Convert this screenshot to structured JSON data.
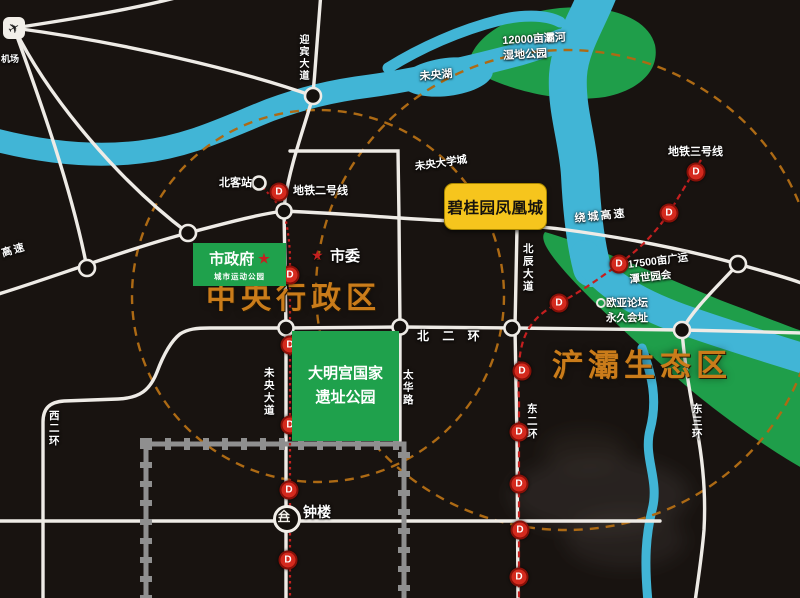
{
  "colors": {
    "background": "#181310",
    "river": "#41b5d6",
    "park_green": "#1f9e4a",
    "road": "#eeebe6",
    "metro_red": "#c51f1f",
    "radius_dash_orange": "#ad6a14",
    "zone_text_orange": "#ca7c1a",
    "project_highlight_yellow": "#f6c51d",
    "city_wall_gray": "#8f8f8f",
    "gov_box_green": "#1fa14c",
    "star_red": "#c42020"
  },
  "project": {
    "name": "碧桂园凤凰城"
  },
  "boxes": {
    "government": {
      "title": "市政府",
      "subtitle": "城市运动公园"
    },
    "daminggong": {
      "text": "大明宫国家\n遗址公园"
    }
  },
  "metro": {
    "marker_letter": "D",
    "line2_label": "地铁二号线",
    "line3_label": "地铁三号线",
    "line2_markers": [
      [
        279,
        192
      ],
      [
        290,
        275
      ],
      [
        290,
        345
      ],
      [
        290,
        425
      ],
      [
        289,
        490
      ],
      [
        288,
        560
      ]
    ],
    "line3_markers": [
      [
        696,
        172
      ],
      [
        669,
        213
      ],
      [
        619,
        264
      ],
      [
        559,
        303
      ],
      [
        522,
        371
      ],
      [
        519,
        432
      ],
      [
        519,
        484
      ],
      [
        520,
        530
      ],
      [
        519,
        577
      ]
    ]
  },
  "labels": [
    {
      "id": "airport-label",
      "t": "机场",
      "x": 1,
      "y": 53,
      "s": 9
    },
    {
      "id": "yingbin-avenue-label",
      "t": "迎宾大道",
      "x": 295,
      "y": 34,
      "s": 10,
      "v": 1
    },
    {
      "id": "weiyang-lake-label",
      "t": "未央湖",
      "x": 419,
      "y": 70,
      "s": 11,
      "r": -5
    },
    {
      "id": "wetland-park-label",
      "t": "12000亩灞河\n湿地公园",
      "x": 502,
      "y": 34,
      "s": 11,
      "r": -3
    },
    {
      "id": "north-station-label",
      "t": "北客站",
      "x": 219,
      "y": 176,
      "s": 11
    },
    {
      "id": "metro-line2-label",
      "t": "地铁二号线",
      "x": 293,
      "y": 184,
      "s": 11
    },
    {
      "id": "weiyang-university-label",
      "t": "未央大学城",
      "x": 414,
      "y": 160,
      "s": 10.5,
      "r": -8
    },
    {
      "id": "metro-line3-label",
      "t": "地铁三号线",
      "x": 668,
      "y": 145,
      "s": 11
    },
    {
      "id": "ring-expressway-label",
      "t": "绕城高速",
      "x": 574,
      "y": 212,
      "s": 11,
      "r": -6,
      "ls": 2
    },
    {
      "id": "expressway-label",
      "t": "高速",
      "x": 0,
      "y": 247,
      "s": 10.5,
      "r": -16,
      "ls": 2
    },
    {
      "id": "beichen-avenue-label",
      "t": "北辰大道",
      "x": 520,
      "y": 243,
      "s": 10.5,
      "v": 1
    },
    {
      "id": "municipal-committee-label",
      "t": "市委",
      "x": 330,
      "y": 246,
      "s": 15
    },
    {
      "id": "north-2nd-ring-label",
      "t": "北 二 环",
      "x": 417,
      "y": 328,
      "s": 12,
      "ls": 5
    },
    {
      "id": "weiyang-avenue-label",
      "t": "未央大道",
      "x": 261,
      "y": 367,
      "s": 10.5,
      "v": 1
    },
    {
      "id": "taihua-road-label",
      "t": "太华路",
      "x": 400,
      "y": 369,
      "s": 10.5,
      "v": 1
    },
    {
      "id": "expo-park-label",
      "t": "17500亩广运\n潭世园会",
      "x": 627,
      "y": 258,
      "s": 10.5,
      "r": -7
    },
    {
      "id": "eurasia-forum-label",
      "t": "欧亚论坛\n永久会址",
      "x": 606,
      "y": 296,
      "s": 10.5
    },
    {
      "id": "west-2nd-ring-label",
      "t": "西二环",
      "x": 46,
      "y": 410,
      "s": 10.5,
      "v": 1
    },
    {
      "id": "east-2nd-ring-label",
      "t": "东二环",
      "x": 524,
      "y": 403,
      "s": 10.5,
      "v": 1
    },
    {
      "id": "east-3rd-ring-label",
      "t": "东三环",
      "x": 689,
      "y": 403,
      "s": 10.5,
      "v": 1
    },
    {
      "id": "bell-tower-label",
      "t": "钟楼",
      "x": 303,
      "y": 503,
      "s": 14
    },
    {
      "id": "central-district-label",
      "t": "中央行政区",
      "x": 206,
      "y": 278,
      "s": 30,
      "ls": 5,
      "cls": "zone"
    },
    {
      "id": "chanba-district-label",
      "t": "浐灞生态区",
      "x": 552,
      "y": 344,
      "s": 31,
      "ls": 5,
      "cls": "zone"
    }
  ],
  "icons": {
    "airport": "airplane-icon",
    "bell_tower": "bell-tower-icon",
    "government_star": "star-icon",
    "committee_star": "star-icon"
  }
}
